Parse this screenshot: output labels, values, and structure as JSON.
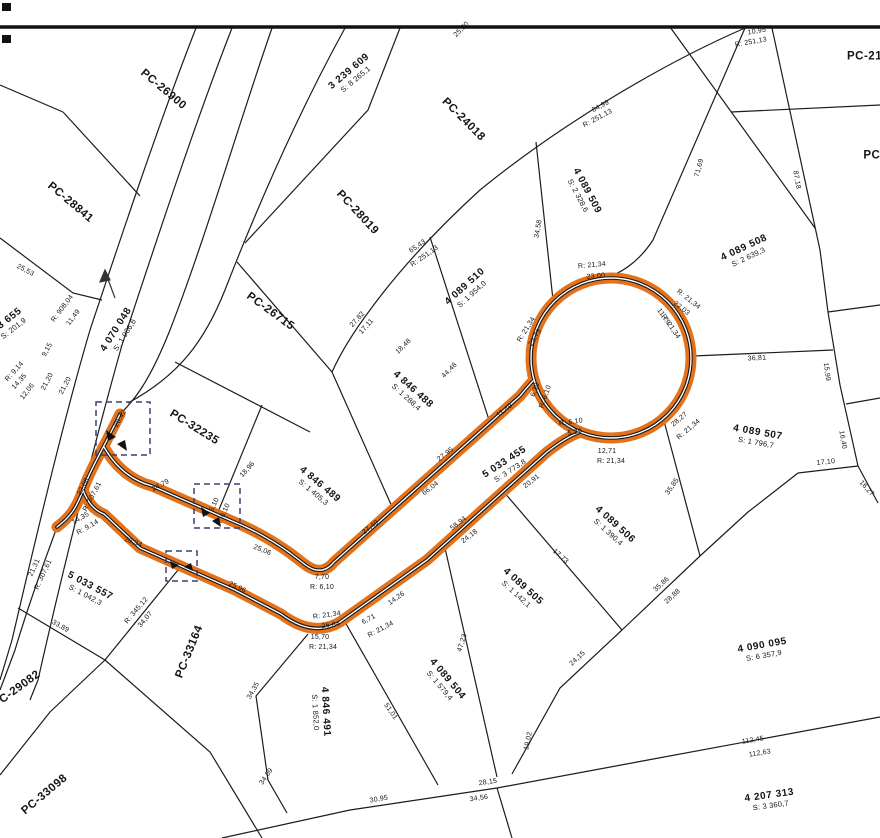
{
  "canvas": {
    "width": 880,
    "height": 838,
    "background": "#ffffff",
    "line_color": "#1c1c1c",
    "road_color": "#e2731c",
    "detail_box_color": "#3d3d73"
  },
  "legend": {
    "highlighted_feature": "proposed road 5 033 455 with cul-de-sac bulb",
    "north_arrow": "north-arrow"
  },
  "labels": [
    {
      "t": [
        "PC-26900"
      ],
      "x": 163,
      "y": 90,
      "r": 40,
      "c": "pc",
      "n": "pc-parcel-label"
    },
    {
      "t": [
        "PC-28841"
      ],
      "x": 70,
      "y": 203,
      "r": 40,
      "c": "pc",
      "n": "pc-parcel-label"
    },
    {
      "t": [
        "PC-24018"
      ],
      "x": 463,
      "y": 120,
      "r": 45,
      "c": "pc",
      "n": "pc-parcel-label"
    },
    {
      "t": [
        "PC-28019"
      ],
      "x": 357,
      "y": 213,
      "r": 47,
      "c": "pc",
      "n": "pc-parcel-label"
    },
    {
      "t": [
        "PC-26715"
      ],
      "x": 270,
      "y": 312,
      "r": 36,
      "c": "pc",
      "n": "pc-parcel-label"
    },
    {
      "t": [
        "PC-32235"
      ],
      "x": 194,
      "y": 428,
      "r": 32,
      "c": "pc",
      "n": "pc-parcel-label"
    },
    {
      "t": [
        "PC-33164"
      ],
      "x": 190,
      "y": 652,
      "r": -68,
      "c": "pc",
      "n": "pc-parcel-label"
    },
    {
      "t": [
        "PC-29082"
      ],
      "x": 17,
      "y": 690,
      "r": -36,
      "c": "pc",
      "n": "pc-parcel-label"
    },
    {
      "t": [
        "PC-33098"
      ],
      "x": 45,
      "y": 795,
      "r": -40,
      "c": "pc",
      "n": "pc-parcel-label"
    },
    {
      "t": [
        "PC-215"
      ],
      "x": 868,
      "y": 57,
      "r": 0,
      "c": "pc",
      "n": "pc-parcel-label"
    },
    {
      "t": [
        "PC-"
      ],
      "x": 874,
      "y": 156,
      "r": 0,
      "c": "pc",
      "n": "pc-parcel-label"
    },
    {
      "t": [
        "3 239 609",
        "S: 8 265,1"
      ],
      "x": 352,
      "y": 75,
      "r": -40,
      "c": "p",
      "n": "parcel-id-label"
    },
    {
      "t": [
        "4 070 048",
        "S: 1 986,6"
      ],
      "x": 120,
      "y": 332,
      "r": -58,
      "c": "p",
      "n": "parcel-id-label"
    },
    {
      "t": [
        "4 089 509",
        "S: 2 328,6"
      ],
      "x": 583,
      "y": 193,
      "r": 62,
      "c": "p",
      "n": "parcel-id-label"
    },
    {
      "t": [
        "4 089 510",
        "S: 1 954,0"
      ],
      "x": 468,
      "y": 290,
      "r": -42,
      "c": "p",
      "n": "parcel-id-label"
    },
    {
      "t": [
        "4 846 488",
        "S: 1 288,4"
      ],
      "x": 410,
      "y": 393,
      "r": 42,
      "c": "p",
      "n": "parcel-id-label"
    },
    {
      "t": [
        "4 846 489",
        "S: 1 405,3"
      ],
      "x": 317,
      "y": 488,
      "r": 40,
      "c": "p",
      "n": "parcel-id-label"
    },
    {
      "t": [
        "5 033 455",
        "S: 3 773,8"
      ],
      "x": 507,
      "y": 466,
      "r": -33,
      "c": "p",
      "n": "parcel-id-label"
    },
    {
      "t": [
        "4 089 508",
        "S: 2 639,3"
      ],
      "x": 746,
      "y": 252,
      "r": -25,
      "c": "p",
      "n": "parcel-id-label"
    },
    {
      "t": [
        "4 089 507",
        "S: 1 796,7"
      ],
      "x": 757,
      "y": 437,
      "r": 10,
      "c": "p",
      "n": "parcel-id-label"
    },
    {
      "t": [
        "4 089 506",
        "S: 1 390,4"
      ],
      "x": 612,
      "y": 528,
      "r": 42,
      "c": "p",
      "n": "parcel-id-label"
    },
    {
      "t": [
        "4 089 505",
        "S: 1 142,1"
      ],
      "x": 520,
      "y": 590,
      "r": 42,
      "c": "p",
      "n": "parcel-id-label"
    },
    {
      "t": [
        "4 089 504",
        "S: 1 579,4"
      ],
      "x": 444,
      "y": 682,
      "r": 50,
      "c": "p",
      "n": "parcel-id-label"
    },
    {
      "t": [
        "5 033 557",
        "S: 1 042,3"
      ],
      "x": 88,
      "y": 590,
      "r": 28,
      "c": "p",
      "n": "parcel-id-label"
    },
    {
      "t": [
        "4 846 491",
        "S: 1 852,0"
      ],
      "x": 321,
      "y": 712,
      "r": 87,
      "c": "p",
      "n": "parcel-id-label"
    },
    {
      "t": [
        "4 090 095",
        "S: 6 357,9"
      ],
      "x": 763,
      "y": 650,
      "r": -10,
      "c": "p",
      "n": "parcel-id-label"
    },
    {
      "t": [
        "4 207 313",
        "S: 3 360,7"
      ],
      "x": 770,
      "y": 800,
      "r": -8,
      "c": "p",
      "n": "parcel-id-label"
    },
    {
      "t": [
        "03 655",
        "S: 201,9"
      ],
      "x": 10,
      "y": 324,
      "r": -38,
      "c": "p",
      "n": "parcel-id-label"
    },
    {
      "t": [
        "25,53"
      ],
      "x": 25,
      "y": 271,
      "r": 28,
      "c": "d",
      "n": "dimension-label"
    },
    {
      "t": [
        "R: 908,04"
      ],
      "x": 63,
      "y": 309,
      "r": -53,
      "c": "d",
      "n": "dimension-label"
    },
    {
      "t": [
        "11,49"
      ],
      "x": 74,
      "y": 318,
      "r": -53,
      "c": "d",
      "n": "dimension-label"
    },
    {
      "t": [
        "9,15"
      ],
      "x": 48,
      "y": 350,
      "r": -62,
      "c": "d",
      "n": "dimension-label"
    },
    {
      "t": [
        "21,20"
      ],
      "x": 48,
      "y": 382,
      "r": -62,
      "c": "d",
      "n": "dimension-label"
    },
    {
      "t": [
        "21,20"
      ],
      "x": 66,
      "y": 386,
      "r": -62,
      "c": "d",
      "n": "dimension-label"
    },
    {
      "t": [
        "12,06"
      ],
      "x": 28,
      "y": 392,
      "r": -52,
      "c": "d",
      "n": "dimension-label"
    },
    {
      "t": [
        "R: 9,14"
      ],
      "x": 15,
      "y": 372,
      "r": -48,
      "c": "d",
      "n": "dimension-label"
    },
    {
      "t": [
        "14,35"
      ],
      "x": 20,
      "y": 382,
      "r": -48,
      "c": "d",
      "n": "dimension-label"
    },
    {
      "t": [
        "25,20"
      ],
      "x": 462,
      "y": 30,
      "r": -45,
      "c": "d",
      "n": "dimension-label"
    },
    {
      "t": [
        "84,99"
      ],
      "x": 601,
      "y": 107,
      "r": -28,
      "c": "d",
      "n": "dimension-label"
    },
    {
      "t": [
        "R: 251,13"
      ],
      "x": 598,
      "y": 119,
      "r": -28,
      "c": "d",
      "n": "dimension-label"
    },
    {
      "t": [
        "10,95"
      ],
      "x": 757,
      "y": 32,
      "r": -10,
      "c": "d",
      "n": "dimension-label"
    },
    {
      "t": [
        "R: 251,13"
      ],
      "x": 751,
      "y": 43,
      "r": -10,
      "c": "d",
      "n": "dimension-label"
    },
    {
      "t": [
        "71,69"
      ],
      "x": 700,
      "y": 168,
      "r": -75,
      "c": "d",
      "n": "dimension-label"
    },
    {
      "t": [
        "87,18"
      ],
      "x": 796,
      "y": 180,
      "r": 80,
      "c": "d",
      "n": "dimension-label"
    },
    {
      "t": [
        "65,43"
      ],
      "x": 418,
      "y": 247,
      "r": -35,
      "c": "d",
      "n": "dimension-label"
    },
    {
      "t": [
        "R: 251,13"
      ],
      "x": 425,
      "y": 257,
      "r": -35,
      "c": "d",
      "n": "dimension-label"
    },
    {
      "t": [
        "27,82"
      ],
      "x": 358,
      "y": 320,
      "r": -48,
      "c": "d",
      "n": "dimension-label"
    },
    {
      "t": [
        "17,11"
      ],
      "x": 367,
      "y": 327,
      "r": -48,
      "c": "d",
      "n": "dimension-label"
    },
    {
      "t": [
        "18,48"
      ],
      "x": 404,
      "y": 347,
      "r": -45,
      "c": "d",
      "n": "dimension-label"
    },
    {
      "t": [
        "44,48"
      ],
      "x": 450,
      "y": 371,
      "r": -45,
      "c": "d",
      "n": "dimension-label"
    },
    {
      "t": [
        "34,58"
      ],
      "x": 539,
      "y": 229,
      "r": -80,
      "c": "d",
      "n": "dimension-label"
    },
    {
      "t": [
        "R: 21,34"
      ],
      "x": 592,
      "y": 266,
      "r": -5,
      "c": "d",
      "n": "dimension-label"
    },
    {
      "t": [
        "23,00"
      ],
      "x": 596,
      "y": 277,
      "r": -5,
      "c": "d",
      "n": "dimension-label"
    },
    {
      "t": [
        "R: 21,34"
      ],
      "x": 688,
      "y": 300,
      "r": 38,
      "c": "d",
      "n": "dimension-label"
    },
    {
      "t": [
        "22,03"
      ],
      "x": 681,
      "y": 309,
      "r": 38,
      "c": "d",
      "n": "dimension-label"
    },
    {
      "t": [
        "11,79"
      ],
      "x": 663,
      "y": 317,
      "r": 55,
      "c": "d",
      "n": "dimension-label"
    },
    {
      "t": [
        "R: 21,34"
      ],
      "x": 670,
      "y": 327,
      "r": 55,
      "c": "d",
      "n": "dimension-label"
    },
    {
      "t": [
        "R: 21,34"
      ],
      "x": 527,
      "y": 330,
      "r": -58,
      "c": "d",
      "n": "dimension-label"
    },
    {
      "t": [
        "22,73"
      ],
      "x": 536,
      "y": 338,
      "r": -58,
      "c": "d",
      "n": "dimension-label"
    },
    {
      "t": [
        "6,39"
      ],
      "x": 536,
      "y": 390,
      "r": -70,
      "c": "d",
      "n": "dimension-label"
    },
    {
      "t": [
        "R: 6,10"
      ],
      "x": 546,
      "y": 397,
      "r": -70,
      "c": "d",
      "n": "dimension-label"
    },
    {
      "t": [
        "R: 6,10"
      ],
      "x": 571,
      "y": 423,
      "r": -8,
      "c": "d",
      "n": "dimension-label"
    },
    {
      "t": [
        "5,29"
      ],
      "x": 575,
      "y": 433,
      "r": -8,
      "c": "d",
      "n": "dimension-label"
    },
    {
      "t": [
        "12,71"
      ],
      "x": 607,
      "y": 452,
      "r": 0,
      "c": "d",
      "n": "dimension-label"
    },
    {
      "t": [
        "R: 21,34"
      ],
      "x": 611,
      "y": 462,
      "r": 0,
      "c": "d",
      "n": "dimension-label"
    },
    {
      "t": [
        "28,27"
      ],
      "x": 680,
      "y": 420,
      "r": -40,
      "c": "d",
      "n": "dimension-label"
    },
    {
      "t": [
        "R: 21,34"
      ],
      "x": 689,
      "y": 430,
      "r": -40,
      "c": "d",
      "n": "dimension-label"
    },
    {
      "t": [
        "36,81"
      ],
      "x": 757,
      "y": 359,
      "r": -3,
      "c": "d",
      "n": "dimension-label"
    },
    {
      "t": [
        "15,99"
      ],
      "x": 826,
      "y": 372,
      "r": 82,
      "c": "d",
      "n": "dimension-label"
    },
    {
      "t": [
        "16,40"
      ],
      "x": 842,
      "y": 440,
      "r": 80,
      "c": "d",
      "n": "dimension-label"
    },
    {
      "t": [
        "17,10"
      ],
      "x": 826,
      "y": 463,
      "r": -6,
      "c": "d",
      "n": "dimension-label"
    },
    {
      "t": [
        "16,27"
      ],
      "x": 866,
      "y": 489,
      "r": 48,
      "c": "d",
      "n": "dimension-label"
    },
    {
      "t": [
        "35,85"
      ],
      "x": 673,
      "y": 487,
      "r": -55,
      "c": "d",
      "n": "dimension-label"
    },
    {
      "t": [
        "35,86"
      ],
      "x": 662,
      "y": 585,
      "r": -43,
      "c": "d",
      "n": "dimension-label"
    },
    {
      "t": [
        "28,88"
      ],
      "x": 673,
      "y": 597,
      "r": -43,
      "c": "d",
      "n": "dimension-label"
    },
    {
      "t": [
        "20,42"
      ],
      "x": 121,
      "y": 419,
      "r": -60,
      "c": "d",
      "n": "dimension-label"
    },
    {
      "t": [
        "24,79"
      ],
      "x": 161,
      "y": 486,
      "r": -28,
      "c": "d",
      "n": "dimension-label"
    },
    {
      "t": [
        "22,68"
      ],
      "x": 84,
      "y": 487,
      "r": -62,
      "c": "d",
      "n": "dimension-label"
    },
    {
      "t": [
        "R: 307,61"
      ],
      "x": 93,
      "y": 497,
      "r": -62,
      "c": "d",
      "n": "dimension-label"
    },
    {
      "t": [
        "14,35"
      ],
      "x": 81,
      "y": 519,
      "r": -30,
      "c": "d",
      "n": "dimension-label"
    },
    {
      "t": [
        "R: 9,14"
      ],
      "x": 88,
      "y": 528,
      "r": -30,
      "c": "d",
      "n": "dimension-label"
    },
    {
      "t": [
        "20,34"
      ],
      "x": 133,
      "y": 543,
      "r": 20,
      "c": "d",
      "n": "dimension-label"
    },
    {
      "t": [
        "21,31"
      ],
      "x": 35,
      "y": 568,
      "r": -65,
      "c": "d",
      "n": "dimension-label"
    },
    {
      "t": [
        "R: 307,61"
      ],
      "x": 44,
      "y": 575,
      "r": -65,
      "c": "d",
      "n": "dimension-label"
    },
    {
      "t": [
        "18,96"
      ],
      "x": 248,
      "y": 470,
      "r": -48,
      "c": "d",
      "n": "dimension-label"
    },
    {
      "t": [
        "6,10"
      ],
      "x": 215,
      "y": 505,
      "r": -65,
      "c": "d",
      "n": "dimension-label"
    },
    {
      "t": [
        "R: 6,10"
      ],
      "x": 224,
      "y": 515,
      "r": -65,
      "c": "d",
      "n": "dimension-label"
    },
    {
      "t": [
        "25,06"
      ],
      "x": 262,
      "y": 551,
      "r": 22,
      "c": "d",
      "n": "dimension-label"
    },
    {
      "t": [
        "25,96"
      ],
      "x": 237,
      "y": 588,
      "r": 25,
      "c": "d",
      "n": "dimension-label"
    },
    {
      "t": [
        "7,70"
      ],
      "x": 322,
      "y": 578,
      "r": 0,
      "c": "d",
      "n": "dimension-label"
    },
    {
      "t": [
        "R: 6,10"
      ],
      "x": 322,
      "y": 588,
      "r": 0,
      "c": "d",
      "n": "dimension-label"
    },
    {
      "t": [
        "27,49"
      ],
      "x": 371,
      "y": 528,
      "r": -38,
      "c": "d",
      "n": "dimension-label"
    },
    {
      "t": [
        "11,49"
      ],
      "x": 505,
      "y": 411,
      "r": -38,
      "c": "d",
      "n": "dimension-label"
    },
    {
      "t": [
        "27,95"
      ],
      "x": 446,
      "y": 455,
      "r": -38,
      "c": "d",
      "n": "dimension-label"
    },
    {
      "t": [
        "66,04"
      ],
      "x": 431,
      "y": 489,
      "r": -38,
      "c": "d",
      "n": "dimension-label"
    },
    {
      "t": [
        "20,91"
      ],
      "x": 532,
      "y": 482,
      "r": -38,
      "c": "d",
      "n": "dimension-label"
    },
    {
      "t": [
        "58,94"
      ],
      "x": 459,
      "y": 524,
      "r": -38,
      "c": "d",
      "n": "dimension-label"
    },
    {
      "t": [
        "24,18"
      ],
      "x": 470,
      "y": 537,
      "r": -38,
      "c": "d",
      "n": "dimension-label"
    },
    {
      "t": [
        "R: 21,34"
      ],
      "x": 327,
      "y": 616,
      "r": -8,
      "c": "d",
      "n": "dimension-label"
    },
    {
      "t": [
        "26,84"
      ],
      "x": 331,
      "y": 626,
      "r": -8,
      "c": "d",
      "n": "dimension-label"
    },
    {
      "t": [
        "15,70"
      ],
      "x": 320,
      "y": 638,
      "r": 0,
      "c": "d",
      "n": "dimension-label"
    },
    {
      "t": [
        "R: 21,34"
      ],
      "x": 323,
      "y": 648,
      "r": 0,
      "c": "d",
      "n": "dimension-label"
    },
    {
      "t": [
        "6,71"
      ],
      "x": 369,
      "y": 620,
      "r": -28,
      "c": "d",
      "n": "dimension-label"
    },
    {
      "t": [
        "R: 21,34"
      ],
      "x": 381,
      "y": 630,
      "r": -28,
      "c": "d",
      "n": "dimension-label"
    },
    {
      "t": [
        "14,26"
      ],
      "x": 397,
      "y": 599,
      "r": -35,
      "c": "d",
      "n": "dimension-label"
    },
    {
      "t": [
        "47,23"
      ],
      "x": 463,
      "y": 643,
      "r": -72,
      "c": "d",
      "n": "dimension-label"
    },
    {
      "t": [
        "17,73"
      ],
      "x": 560,
      "y": 557,
      "r": 42,
      "c": "d",
      "n": "dimension-label"
    },
    {
      "t": [
        "24,15"
      ],
      "x": 578,
      "y": 659,
      "r": -43,
      "c": "d",
      "n": "dimension-label"
    },
    {
      "t": [
        "19,02"
      ],
      "x": 529,
      "y": 741,
      "r": -78,
      "c": "d",
      "n": "dimension-label"
    },
    {
      "t": [
        "51,01"
      ],
      "x": 390,
      "y": 712,
      "r": 55,
      "c": "d",
      "n": "dimension-label"
    },
    {
      "t": [
        "34,35"
      ],
      "x": 254,
      "y": 691,
      "r": -60,
      "c": "d",
      "n": "dimension-label"
    },
    {
      "t": [
        "34,69"
      ],
      "x": 267,
      "y": 777,
      "r": -55,
      "c": "d",
      "n": "dimension-label"
    },
    {
      "t": [
        "30,95"
      ],
      "x": 379,
      "y": 800,
      "r": -10,
      "c": "d",
      "n": "dimension-label"
    },
    {
      "t": [
        "28,15"
      ],
      "x": 488,
      "y": 783,
      "r": -8,
      "c": "d",
      "n": "dimension-label"
    },
    {
      "t": [
        "34,56"
      ],
      "x": 479,
      "y": 799,
      "r": -8,
      "c": "d",
      "n": "dimension-label"
    },
    {
      "t": [
        "112,45"
      ],
      "x": 753,
      "y": 741,
      "r": -9,
      "c": "d",
      "n": "dimension-label"
    },
    {
      "t": [
        "112,63"
      ],
      "x": 760,
      "y": 754,
      "r": -9,
      "c": "d",
      "n": "dimension-label"
    },
    {
      "t": [
        "R: 345,12"
      ],
      "x": 137,
      "y": 611,
      "r": -50,
      "c": "d",
      "n": "dimension-label"
    },
    {
      "t": [
        "34,07"
      ],
      "x": 146,
      "y": 620,
      "r": -50,
      "c": "d",
      "n": "dimension-label"
    },
    {
      "t": [
        "33,89"
      ],
      "x": 60,
      "y": 627,
      "r": 30,
      "c": "d",
      "n": "dimension-label"
    }
  ]
}
